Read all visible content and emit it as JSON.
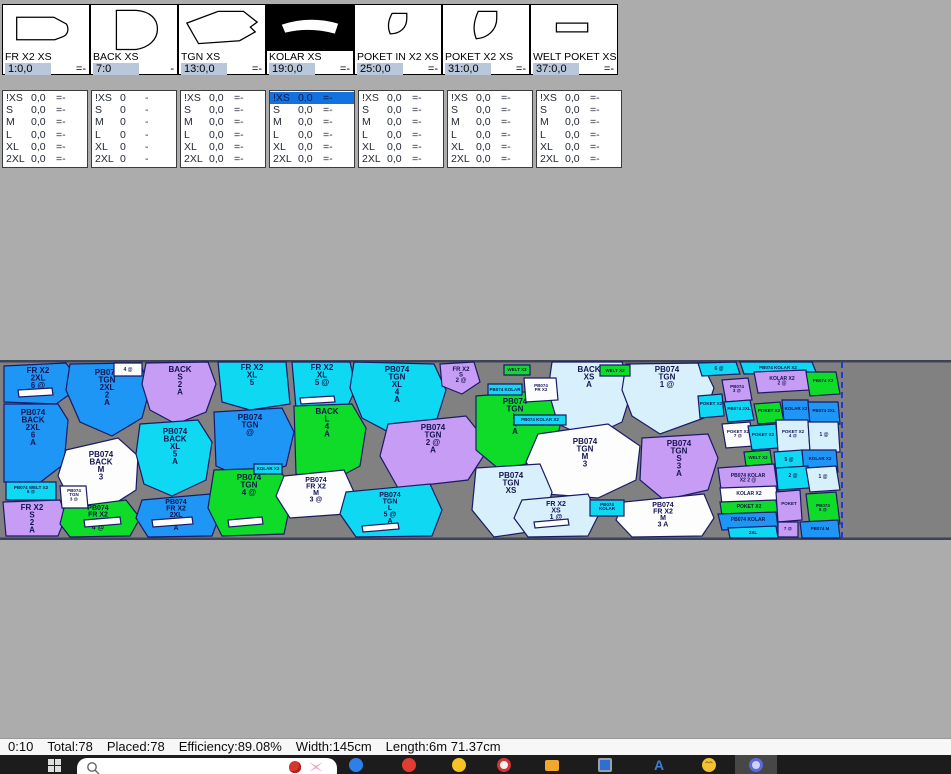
{
  "pieces_panel": {
    "cards": [
      {
        "name": "FR X2 XS",
        "value": "1:0,0",
        "suffix": "=-",
        "thumb": "fr",
        "selected": false
      },
      {
        "name": "BACK XS",
        "value": "7:0",
        "suffix": "-",
        "thumb": "back",
        "selected": false
      },
      {
        "name": "TGN XS",
        "value": "13:0,0",
        "suffix": "=-",
        "thumb": "tgn",
        "selected": false
      },
      {
        "name": "KOLAR XS",
        "value": "19:0,0",
        "suffix": "=-",
        "thumb": "kolar",
        "selected": true
      },
      {
        "name": "POKET IN X2 XS",
        "value": "25:0,0",
        "suffix": "=-",
        "thumb": "poket_in",
        "selected": false
      },
      {
        "name": "POKET X2 XS",
        "value": "31:0,0",
        "suffix": "=-",
        "thumb": "poket",
        "selected": false
      },
      {
        "name": "WELT POKET XS",
        "value": "37:0,0",
        "suffix": "=-",
        "thumb": "welt",
        "selected": false
      }
    ]
  },
  "size_table": {
    "sizes": [
      "!XS",
      "S",
      "M",
      "L",
      "XL",
      "2XL"
    ],
    "columns": [
      {
        "value": "0,0",
        "suffix": "=-",
        "selected_row": -1
      },
      {
        "value": "0",
        "suffix": "-",
        "selected_row": -1
      },
      {
        "value": "0,0",
        "suffix": "=-",
        "selected_row": -1
      },
      {
        "value": "0,0",
        "suffix": "=-",
        "selected_row": 0
      },
      {
        "value": "0,0",
        "suffix": "=-",
        "selected_row": -1
      },
      {
        "value": "0,0",
        "suffix": "=-",
        "selected_row": -1
      },
      {
        "value": "0,0",
        "suffix": "=-",
        "selected_row": -1
      }
    ],
    "selection_color": "#1272e0"
  },
  "marker": {
    "content_end_x": 842,
    "colors": {
      "B": "#1e96f5",
      "C": "#0fd8f2",
      "G": "#0edc28",
      "P": "#c79cf5",
      "W": "#fdfdfd",
      "L": "#d8f0fc",
      "outline": "#1a1a66",
      "text": "#141450",
      "band": "#818181",
      "band_border": "#3d4356",
      "end_line": "#2438d8"
    },
    "pieces": [
      {
        "f": "B",
        "p": "4,6 66,3 74,14 70,34 56,44 4,42",
        "x": 38,
        "y": 13,
        "s": 8,
        "t": [
          "FR X2",
          "2XL",
          "6 @",
          "A"
        ]
      },
      {
        "f": "B",
        "p": "70,4 140,3 150,28 142,58 112,76 80,62 66,30",
        "x": 107,
        "y": 15,
        "s": 8,
        "t": [
          "PB074",
          "TGN",
          "2XL",
          "2",
          "A"
        ]
      },
      {
        "f": "B",
        "p": "4,44 58,44 68,60 64,104 38,124 4,122",
        "x": 33,
        "y": 55,
        "s": 8,
        "t": [
          "PB074",
          "BACK",
          "2XL",
          "6",
          "A"
        ]
      },
      {
        "f": "W",
        "p": "66,90 118,78 138,96 136,130 108,148 72,144 58,116",
        "x": 101,
        "y": 97,
        "s": 8,
        "t": [
          "PB074",
          "BACK",
          "M",
          "3"
        ]
      },
      {
        "f": "P",
        "p": "146,3 208,2 216,24 206,52 176,64 150,50 142,24",
        "x": 180,
        "y": 12,
        "s": 8,
        "t": [
          "BACK",
          "S",
          "2",
          "A"
        ]
      },
      {
        "f": "C",
        "p": "140,64 198,60 212,82 206,120 172,136 144,124 136,94",
        "x": 175,
        "y": 74,
        "s": 8,
        "t": [
          "PB074",
          "BACK",
          "XL",
          "5",
          "A"
        ]
      },
      {
        "f": "P",
        "p": "3,142 60,140 66,156 58,176 6,176",
        "x": 32,
        "y": 150,
        "s": 8,
        "t": [
          "FR X2",
          "S",
          "2",
          "A"
        ]
      },
      {
        "f": "G",
        "p": "64,148 126,140 140,158 130,176 70,177 60,164",
        "x": 98,
        "y": 150,
        "s": 7,
        "t": [
          "PB074",
          "FR X2",
          "L",
          "4 @"
        ]
      },
      {
        "f": "B",
        "p": "142,140 210,134 220,154 212,176 148,177 136,158",
        "x": 176,
        "y": 144,
        "s": 7,
        "t": [
          "PB074",
          "FR X2",
          "2XL",
          "6",
          "A"
        ]
      },
      {
        "f": "C",
        "p": "218,2 286,2 290,44 250,50 222,42",
        "x": 252,
        "y": 10,
        "s": 8,
        "t": [
          "FR X2",
          "XL",
          "5"
        ]
      },
      {
        "f": "C",
        "p": "292,2 350,2 356,28 346,50 296,48",
        "x": 322,
        "y": 10,
        "s": 8,
        "t": [
          "FR X2",
          "XL",
          "5 @"
        ]
      },
      {
        "f": "C",
        "p": "354,2 434,4 446,30 436,62 396,76 362,58 350,28",
        "x": 397,
        "y": 12,
        "s": 8,
        "t": [
          "PB074",
          "TGN",
          "XL",
          "4",
          "A"
        ]
      },
      {
        "f": "B",
        "p": "214,52 282,48 294,72 286,106 244,118 216,106",
        "x": 250,
        "y": 60,
        "s": 8,
        "t": [
          "PB074",
          "TGN",
          "@"
        ]
      },
      {
        "f": "G",
        "p": "294,46 352,44 366,68 360,106 330,122 296,114",
        "x": 327,
        "y": 54,
        "s": 8,
        "t": [
          "BACK",
          "L",
          "4",
          "A"
        ]
      },
      {
        "f": "P",
        "p": "388,64 466,56 490,86 468,120 398,128 380,96",
        "x": 433,
        "y": 70,
        "s": 8,
        "t": [
          "PB074",
          "TGN",
          "2 @",
          "A"
        ]
      },
      {
        "f": "G",
        "p": "214,110 280,108 292,136 284,174 222,176 208,148",
        "x": 249,
        "y": 120,
        "s": 8,
        "t": [
          "PB074",
          "TGN",
          "4 @"
        ]
      },
      {
        "f": "W",
        "p": "284,116 344,110 354,132 346,154 290,158 276,136",
        "x": 316,
        "y": 122,
        "s": 7,
        "t": [
          "PB074",
          "FR X2",
          "M",
          "3 @"
        ]
      },
      {
        "f": "C",
        "p": "346,132 430,124 442,150 432,176 356,177 340,154",
        "x": 390,
        "y": 137,
        "s": 7,
        "t": [
          "PB074",
          "TGN",
          "L",
          "5 @",
          "A"
        ]
      },
      {
        "f": "G",
        "p": "476,36 548,30 562,58 552,98 500,110 476,90",
        "x": 515,
        "y": 44,
        "s": 8,
        "t": [
          "PB074",
          "TGN",
          "L",
          "4",
          "A"
        ]
      },
      {
        "f": "L",
        "p": "552,2 622,2 632,30 622,62 588,78 558,64 548,30",
        "x": 589,
        "y": 12,
        "s": 8,
        "t": [
          "BACK",
          "XS",
          "A"
        ]
      },
      {
        "f": "L",
        "p": "626,4 702,3 714,28 704,58 660,74 632,56 622,30",
        "x": 667,
        "y": 12,
        "s": 8,
        "t": [
          "PB074",
          "TGN",
          "1 @"
        ]
      },
      {
        "f": "W",
        "p": "538,74 608,64 640,86 636,120 598,138 546,134 526,102",
        "x": 585,
        "y": 84,
        "s": 8,
        "t": [
          "PB074",
          "TGN",
          "M",
          "3"
        ]
      },
      {
        "f": "P",
        "p": "642,78 708,74 718,98 708,130 664,140 640,120",
        "x": 679,
        "y": 86,
        "s": 8,
        "t": [
          "PB074",
          "TGN",
          "S",
          "3",
          "A"
        ]
      },
      {
        "f": "L",
        "p": "476,108 540,104 552,132 542,170 494,177 472,150",
        "x": 511,
        "y": 118,
        "s": 8,
        "t": [
          "PB074",
          "TGN",
          "XS"
        ]
      },
      {
        "f": "L",
        "p": "522,140 588,134 598,156 588,176 528,177 514,158",
        "x": 556,
        "y": 146,
        "s": 7,
        "t": [
          "FR X2",
          "XS",
          "1 @"
        ]
      },
      {
        "f": "W",
        "p": "624,142 704,134 714,158 702,176 632,177 616,160",
        "x": 663,
        "y": 147,
        "s": 7,
        "t": [
          "PB074",
          "FR X2",
          "M",
          "3 A"
        ]
      },
      {
        "f": "P",
        "p": "440,4 474,2 480,22 462,34 442,26",
        "x": 461,
        "y": 11,
        "s": 6,
        "t": [
          "FR X2",
          "S",
          "2 @"
        ]
      },
      {
        "f": "W",
        "p": "114,3 142,3 142,16 114,16",
        "x": 128,
        "y": 11,
        "s": 5,
        "t": [
          "4 @"
        ]
      },
      {
        "f": "C",
        "p": "6,122 56,122 56,140 6,140",
        "x": 31,
        "y": 129,
        "s": 4.5,
        "t": [
          "PB074 WELT X2",
          "6 @"
        ]
      },
      {
        "f": "W",
        "p": "60,126 86,126 88,148 62,148",
        "x": 74,
        "y": 132,
        "s": 4.5,
        "t": [
          "PB074",
          "TGN",
          "3 @"
        ]
      },
      {
        "f": "C",
        "p": "254,104 282,104 282,114 254,114",
        "x": 268,
        "y": 110,
        "s": 4.5,
        "t": [
          "KOLAR X2"
        ]
      },
      {
        "f": "G",
        "p": "504,5 530,5 530,15 504,15",
        "x": 517,
        "y": 11,
        "s": 4.5,
        "t": [
          "WELT X2"
        ]
      },
      {
        "f": "C",
        "p": "488,24 522,24 522,35 488,35",
        "x": 505,
        "y": 31,
        "s": 4.5,
        "t": [
          "PB074 KOLAR"
        ]
      },
      {
        "f": "W",
        "p": "524,18 556,18 558,40 526,42",
        "x": 541,
        "y": 27,
        "s": 4.5,
        "t": [
          "PB074",
          "FR X2"
        ]
      },
      {
        "f": "G",
        "p": "600,5 630,5 630,16 600,16",
        "x": 615,
        "y": 12,
        "s": 4.5,
        "t": [
          "WELT X2"
        ]
      },
      {
        "f": "C",
        "p": "514,55 566,55 566,65 514,65",
        "x": 540,
        "y": 61,
        "s": 4.5,
        "t": [
          "PB074 KOLAR X2"
        ]
      },
      {
        "f": "C",
        "p": "590,140 624,140 624,156 590,156",
        "x": 607,
        "y": 146,
        "s": 4.5,
        "t": [
          "PB074",
          "KOLAR"
        ]
      },
      {
        "f": "C",
        "p": "698,3 736,2 740,14 702,16",
        "x": 719,
        "y": 10,
        "s": 5,
        "t": [
          "6 @"
        ]
      },
      {
        "f": "C",
        "p": "740,2 812,2 816,12 744,14",
        "x": 778,
        "y": 9,
        "s": 4.5,
        "t": [
          "PB074 KOLAR X2"
        ]
      },
      {
        "f": "P",
        "p": "754,12 806,10 810,30 758,33",
        "x": 782,
        "y": 20,
        "s": 5,
        "t": [
          "KOLAR X2",
          "2 @"
        ]
      },
      {
        "f": "G",
        "p": "806,12 836,12 840,34 810,36",
        "x": 823,
        "y": 22,
        "s": 4.5,
        "t": [
          "PB074 X2"
        ]
      },
      {
        "f": "P",
        "p": "722,20 748,18 752,40 726,42",
        "x": 737,
        "y": 28,
        "s": 4.5,
        "t": [
          "PB074",
          "3 @"
        ]
      },
      {
        "f": "C",
        "p": "698,36 722,34 724,56 700,58",
        "x": 711,
        "y": 45,
        "s": 4.5,
        "t": [
          "POKET X2"
        ]
      },
      {
        "f": "C",
        "p": "724,42 750,40 754,60 728,62",
        "x": 739,
        "y": 50,
        "s": 4.5,
        "t": [
          "PB074 2XL"
        ]
      },
      {
        "f": "G",
        "p": "754,44 780,42 784,62 758,64",
        "x": 769,
        "y": 52,
        "s": 4.5,
        "t": [
          "POKET X2"
        ]
      },
      {
        "f": "B",
        "p": "782,40 808,40 810,62 784,62",
        "x": 796,
        "y": 50,
        "s": 4.5,
        "t": [
          "KOLAR X2"
        ]
      },
      {
        "f": "B",
        "p": "808,42 838,42 840,64 810,64",
        "x": 824,
        "y": 52,
        "s": 4.5,
        "t": [
          "PB074 2XL"
        ]
      },
      {
        "f": "W",
        "p": "722,64 750,62 754,86 726,88",
        "x": 738,
        "y": 73,
        "s": 4.5,
        "t": [
          "POKET X2",
          "7 @"
        ]
      },
      {
        "f": "C",
        "p": "748,66 776,64 778,88 752,90",
        "x": 763,
        "y": 76,
        "s": 4.5,
        "t": [
          "POKET X2"
        ]
      },
      {
        "f": "L",
        "p": "776,60 808,60 810,90 778,92",
        "x": 793,
        "y": 73,
        "s": 4.5,
        "t": [
          "POKET X2",
          "4 @"
        ]
      },
      {
        "f": "L",
        "p": "808,62 838,62 840,92 810,92",
        "x": 824,
        "y": 76,
        "s": 5,
        "t": [
          "1 @"
        ]
      },
      {
        "f": "G",
        "p": "744,92 770,90 772,104 746,106",
        "x": 758,
        "y": 99,
        "s": 4.5,
        "t": [
          "WELT X2"
        ]
      },
      {
        "f": "C",
        "p": "774,92 802,90 804,110 776,112",
        "x": 789,
        "y": 101,
        "s": 5,
        "t": [
          "5 @"
        ]
      },
      {
        "f": "B",
        "p": "802,90 836,90 838,112 804,112",
        "x": 820,
        "y": 100,
        "s": 4.5,
        "t": [
          "KOLAR X2"
        ]
      },
      {
        "f": "P",
        "p": "718,108 774,104 778,132 722,136",
        "x": 748,
        "y": 117,
        "s": 5,
        "t": [
          "PB074 KOLAR",
          "X2 2 @"
        ]
      },
      {
        "f": "C",
        "p": "776,108 808,106 810,128 778,130",
        "x": 793,
        "y": 117,
        "s": 5,
        "t": [
          "2 @"
        ]
      },
      {
        "f": "L",
        "p": "806,108 836,106 840,130 810,132",
        "x": 823,
        "y": 118,
        "s": 5,
        "t": [
          "1 @"
        ]
      },
      {
        "f": "W",
        "p": "720,128 776,126 778,142 722,144",
        "x": 749,
        "y": 135,
        "s": 5,
        "t": [
          "KOLAR X2"
        ]
      },
      {
        "f": "G",
        "p": "720,142 776,140 778,154 722,156",
        "x": 749,
        "y": 148,
        "s": 5,
        "t": [
          "POKET X2"
        ]
      },
      {
        "f": "B",
        "p": "718,154 776,152 778,168 722,170",
        "x": 748,
        "y": 161,
        "s": 5,
        "t": [
          "PB074 KOLAR"
        ]
      },
      {
        "f": "P",
        "p": "776,132 800,130 802,160 778,162",
        "x": 789,
        "y": 145,
        "s": 4.5,
        "t": [
          "POKET"
        ]
      },
      {
        "f": "G",
        "p": "806,134 836,132 840,164 810,166",
        "x": 823,
        "y": 147,
        "s": 4.5,
        "t": [
          "PB074",
          "5 @"
        ]
      },
      {
        "f": "C",
        "p": "728,168 776,166 778,178 730,178",
        "x": 753,
        "y": 174,
        "s": 4.5,
        "t": [
          "2XL"
        ]
      },
      {
        "f": "B",
        "p": "800,162 838,160 840,178 802,178",
        "x": 820,
        "y": 170,
        "s": 4.5,
        "t": [
          "PB074 M"
        ]
      },
      {
        "f": "P",
        "p": "778,162 798,162 798,177 778,177",
        "x": 788,
        "y": 170,
        "s": 4.5,
        "t": [
          "7 @"
        ]
      },
      {
        "f": "W",
        "p": "18,30 52,28 53,35 19,37",
        "x": 0,
        "y": 0,
        "s": 4,
        "t": []
      },
      {
        "f": "W",
        "p": "84,160 120,157 121,164 85,167",
        "x": 0,
        "y": 0,
        "s": 4,
        "t": []
      },
      {
        "f": "W",
        "p": "152,160 192,157 193,164 153,167",
        "x": 0,
        "y": 0,
        "s": 4,
        "t": []
      },
      {
        "f": "W",
        "p": "300,38 334,36 335,42 301,44",
        "x": 0,
        "y": 0,
        "s": 4,
        "t": []
      },
      {
        "f": "W",
        "p": "228,160 262,157 263,164 229,167",
        "x": 0,
        "y": 0,
        "s": 4,
        "t": []
      },
      {
        "f": "W",
        "p": "362,166 398,163 399,169 363,172",
        "x": 0,
        "y": 0,
        "s": 4,
        "t": []
      },
      {
        "f": "W",
        "p": "534,162 568,159 569,165 535,168",
        "x": 0,
        "y": 0,
        "s": 4,
        "t": []
      }
    ]
  },
  "status_bar": {
    "time": "0:10",
    "total": "Total:78",
    "placed": "Placed:78",
    "efficiency": "Efficiency:89.08%",
    "width": "Width:145cm",
    "length": "Length:6m 71.37cm"
  },
  "taskbar": {
    "search": {
      "icon": "search-icon",
      "emojis": [
        "flower-emoji-icon",
        "bow-emoji-icon"
      ]
    },
    "icons": [
      {
        "name": "edge-browser-icon",
        "shape": "circle",
        "color": "#2f7fe8",
        "x": 349
      },
      {
        "name": "browser-red-icon",
        "shape": "circle",
        "color": "#e23b32",
        "x": 402
      },
      {
        "name": "app-yellow-icon",
        "shape": "circle",
        "color": "#f5c324",
        "x": 452
      },
      {
        "name": "app-red-white-icon",
        "shape": "circle2",
        "color": "#f3f3f3",
        "x": 497
      },
      {
        "name": "file-explorer-icon",
        "shape": "folder",
        "color": "#f0a82c",
        "x": 545
      },
      {
        "name": "app-window-icon",
        "shape": "monitor",
        "color": "#2f6fd0",
        "x": 598
      },
      {
        "name": "app-letter-a-icon",
        "shape": "letter",
        "color": "#3b7fd4",
        "char": "A",
        "x": 652
      },
      {
        "name": "emoji-smiley-icon",
        "shape": "smiley",
        "color": "#f2c230",
        "x": 702
      },
      {
        "name": "active-app-icon",
        "shape": "ring",
        "color": "#cdd3f8",
        "x": 749,
        "active": true,
        "slot_x": 735
      }
    ]
  }
}
